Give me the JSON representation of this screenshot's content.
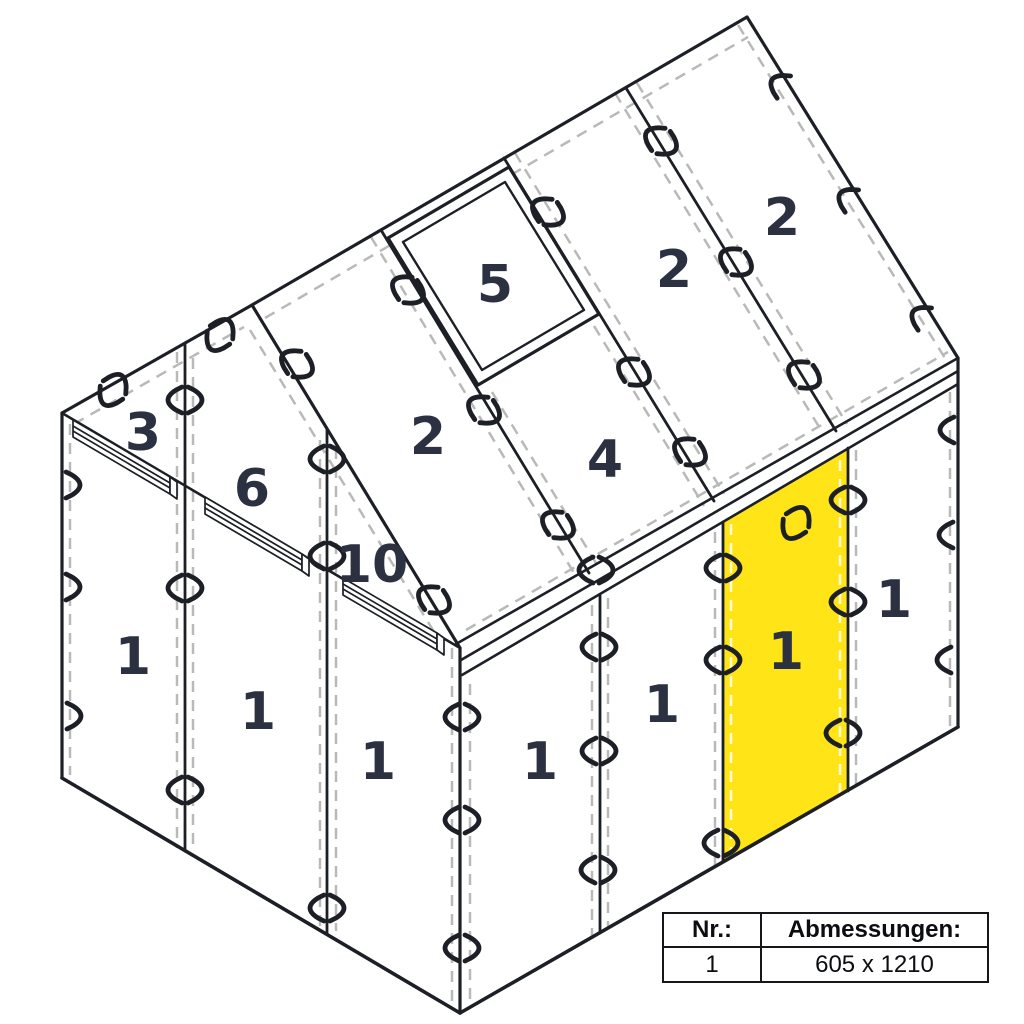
{
  "diagram": {
    "title_semantic": "greenhouse-glazing-panel-layout",
    "labels": {
      "bar_3": "3",
      "bar_6": "6",
      "bar_10": "10",
      "gable_panel_1": "1",
      "gable_panel_2": "1",
      "gable_panel_3": "1",
      "roof_front": "2",
      "window": "5",
      "roof_under_window": "4",
      "roof_mid": "2",
      "roof_back": "2",
      "wall_panel_1": "1",
      "wall_panel_2": "1",
      "wall_panel_3_highlighted": "1",
      "wall_panel_4": "1"
    },
    "colors": {
      "highlight": "#FFE417",
      "line": "#1c2026",
      "dash": "#b9b9b9",
      "dash_on_highlight": "#ffffff",
      "label": "#2b3140"
    }
  },
  "table": {
    "headers": [
      "Nr.:",
      "Abmessungen:"
    ],
    "rows": [
      {
        "nr": "1",
        "dimensions": "605 x 1210"
      }
    ]
  }
}
